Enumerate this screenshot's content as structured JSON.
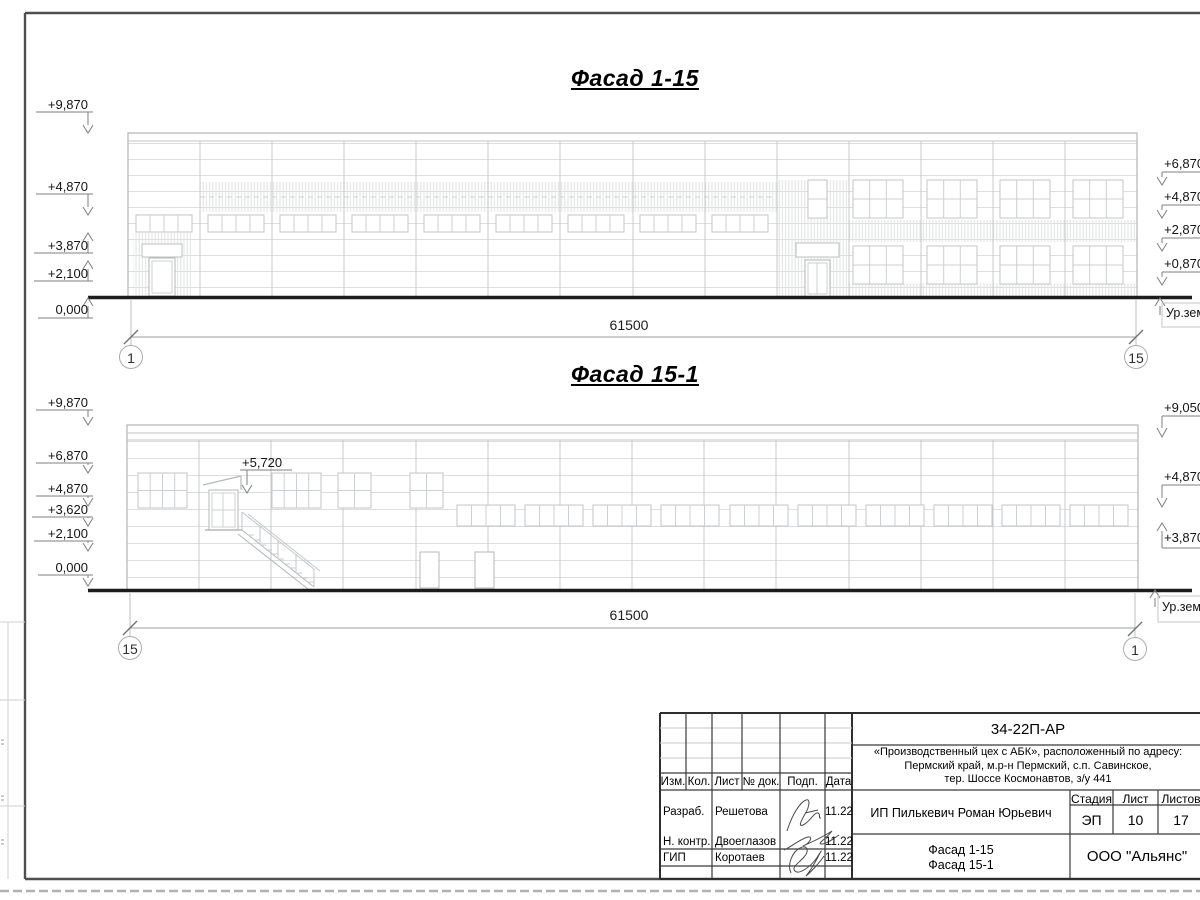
{
  "facade1": {
    "title": "Фасад 1-15",
    "dimension": "61500",
    "grid_left": "1",
    "grid_right": "15",
    "elev_left": [
      "+9,870",
      "+4,870",
      "+3,870",
      "+2,100",
      "0,000"
    ],
    "elev_right": [
      "+6,870",
      "+4,870",
      "+2,870",
      "+0,870"
    ],
    "ground_label": "Ур.земли"
  },
  "facade2": {
    "title": "Фасад 15-1",
    "dimension": "61500",
    "grid_left": "15",
    "grid_right": "1",
    "elev_left": [
      "+9,870",
      "+6,870",
      "+4,870",
      "+3,620",
      "+2,100",
      "0,000"
    ],
    "elev_right": [
      "+9,050",
      "+4,870",
      "+3,870"
    ],
    "stair_mark": "+5,720",
    "ground_label": "Ур.земли"
  },
  "titleblock": {
    "doc_number": "34-22П-АР",
    "project_address_lines": [
      "«Производственный цех с АБК», расположенный по адресу:",
      "Пермский край, м.р-н Пермский, с.п. Савинское,",
      "тер. Шоссе Космонавтов, з/у 441"
    ],
    "client": "ИП Пилькевич Роман Юрьевич",
    "stage_label": "Стадия",
    "sheet_label": "Лист",
    "sheets_label": "Листов",
    "stage_value": "ЭП",
    "sheet_value": "10",
    "sheets_value": "17",
    "drawing_titles": [
      "Фасад 1-15",
      "Фасад 15-1"
    ],
    "company": "ООО \"Альянс\"",
    "columns": [
      "Изм.",
      "Кол.",
      "Лист",
      "№ док.",
      "Подп.",
      "Дата"
    ],
    "rows": [
      {
        "role": "Разраб.",
        "name": "Решетова",
        "date": "11.22"
      },
      {
        "role": "Н. контр.",
        "name": "Двоеглазов",
        "date": "11.22"
      },
      {
        "role": "ГИП",
        "name": "Коротаев",
        "date": "11.22"
      }
    ]
  },
  "colors": {
    "drawing_line_light": "#dadddf",
    "drawing_line_mid": "#c2c6c8",
    "ground_line": "#1c1c1c",
    "frame": "#4f4f4f",
    "text": "#141414"
  }
}
